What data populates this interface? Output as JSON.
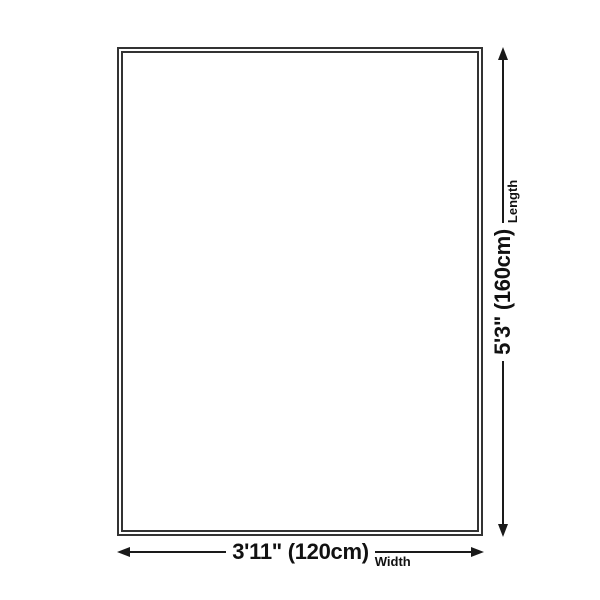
{
  "diagram": {
    "type": "product-size-diagram",
    "shape": "rectangle",
    "length": {
      "value": "5'3\" (160cm)",
      "label": "Length"
    },
    "width": {
      "value": "3'11\" (120cm)",
      "label": "Width"
    },
    "colors": {
      "background": "#ffffff",
      "outline": "#333333",
      "dimension_line": "#1a1a1a",
      "text": "#111111"
    }
  }
}
